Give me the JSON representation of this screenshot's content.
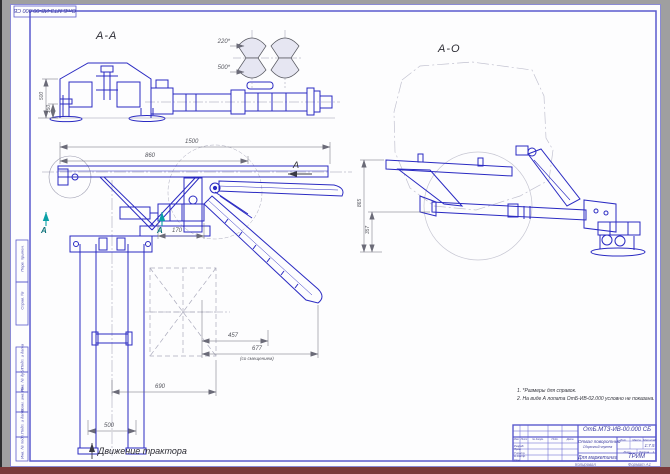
{
  "sheet": {
    "corner_stamp": "ОтБ.МТЗ-ИВ-00.000 СБ",
    "margin_top": [
      "Перв. примен.",
      "Справ. №"
    ],
    "margin_bottom": [
      "Подп. и дата",
      "Инв. № дубл.",
      "Взам. инв. №",
      "Подп. и дата",
      "Инв. № подл."
    ],
    "footer_copied": "Копировал",
    "footer_format": "Формат А1"
  },
  "views": {
    "section_label": "А-А",
    "side_view_label": "А-О",
    "movement_label": "Движение трактора",
    "view_arrow": "А",
    "cut_arrow_left": "А",
    "cut_arrow_right": "А"
  },
  "dimensions": {
    "overall_width": "1500",
    "frame_width": "860",
    "cylinder_stroke": "170",
    "blade_offset_1": "457",
    "blade_offset_2": "677",
    "blade_offset_note": "(со смещением)",
    "track": "690",
    "rail_gap": "500",
    "aa_height": "500",
    "aa_ground": "150",
    "disc_min": "220*",
    "disc_max": "500*",
    "ao_height": "865",
    "ao_ground": "357"
  },
  "notes": [
    "1. *Размеры для справок.",
    "2. На виде А лопата ОтБ-ИВ-02.000 условно не показана."
  ],
  "title_block": {
    "designation": "ОтБ.МТЗ-ИВ-00.000 СБ",
    "part_name": "Отвал поворотный",
    "doc_type": "Сборочный чертеж",
    "purpose": "Для маркетинга",
    "org": "ТРИМ",
    "scale_value": "1:7.5",
    "sheets_value": "1",
    "labels": {
      "lit": "Лит.",
      "mass": "Масса",
      "scale": "Масштаб",
      "sheet": "Лист",
      "sheets": "Листов",
      "header": [
        "Изм.",
        "Лист",
        "№ докум.",
        "Подп.",
        "Дата"
      ],
      "roles": [
        "Разраб.",
        "Пров.",
        "Т.контр.",
        "Н.контр.",
        "Утв."
      ]
    }
  }
}
